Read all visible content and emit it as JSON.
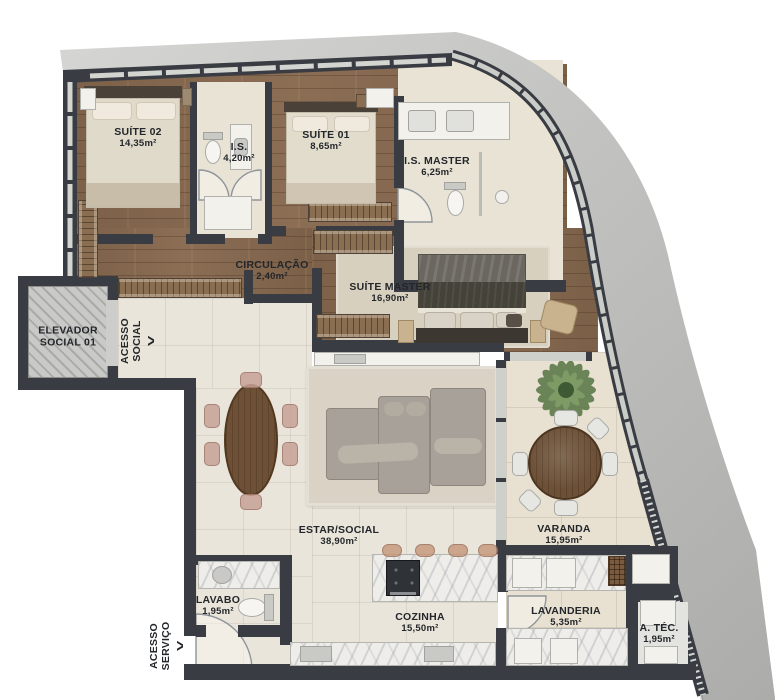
{
  "plan": {
    "rooms": [
      {
        "id": "suite-02",
        "name": "SUÍTE 02",
        "area": "14,35m²"
      },
      {
        "id": "is",
        "name": "I.S.",
        "area": "4,20m²"
      },
      {
        "id": "suite-01",
        "name": "SUÍTE 01",
        "area": "8,65m²"
      },
      {
        "id": "is-master",
        "name": "I.S. MASTER",
        "area": "6,25m²"
      },
      {
        "id": "circulacao",
        "name": "CIRCULAÇÃO",
        "area": "2,40m²"
      },
      {
        "id": "suite-master",
        "name": "SUÍTE MASTER",
        "area": "16,90m²"
      },
      {
        "id": "estar-social",
        "name": "ESTAR/SOCIAL",
        "area": "38,90m²"
      },
      {
        "id": "varanda",
        "name": "VARANDA",
        "area": "15,95m²"
      },
      {
        "id": "lavabo",
        "name": "LAVABO",
        "area": "1,95m²"
      },
      {
        "id": "cozinha",
        "name": "COZINHA",
        "area": "15,50m²"
      },
      {
        "id": "lavanderia",
        "name": "LAVANDERIA",
        "area": "5,35m²"
      },
      {
        "id": "a-tec",
        "name": "A. TÉC.",
        "area": "1,95m²"
      }
    ],
    "elevator": {
      "line1": "ELEVADOR",
      "line2": "SOCIAL 01"
    },
    "access_social": {
      "line1": "ACESSO",
      "line2": "SOCIAL",
      "arrow": ">"
    },
    "access_service": {
      "line1": "ACESSO",
      "line2": "SERVIÇO",
      "arrow": ">"
    },
    "colors": {
      "wall": "#393d43",
      "concrete": "#c4c4c2",
      "wood_floor": "#8a6e55",
      "tile": "#eae5da",
      "varanda_tile": "#e8e1d1",
      "marble": "#eeedea",
      "rug": "#d9d2c3",
      "sofa": "#a7a199",
      "table_wood": "#6d5036",
      "plant_green": "#5d7a4b",
      "label_text": "#23262a"
    }
  }
}
